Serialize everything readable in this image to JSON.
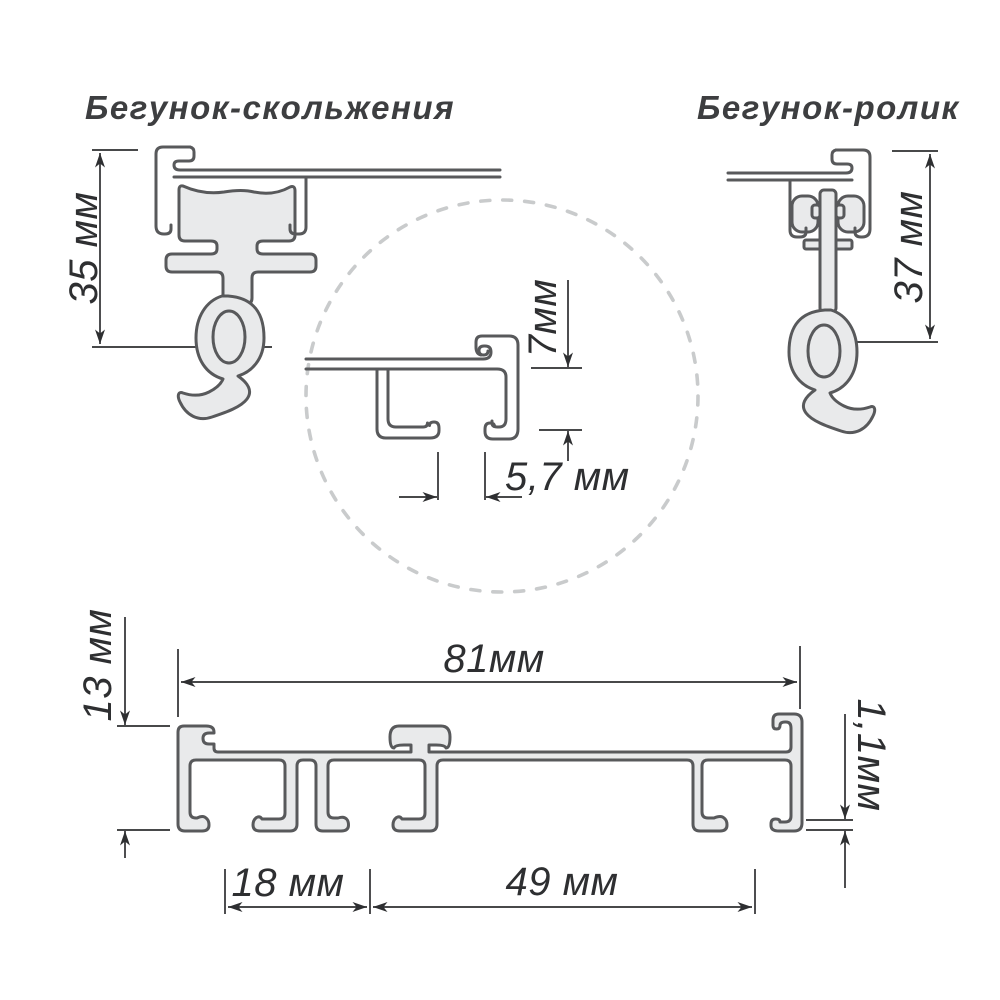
{
  "page": {
    "background": "#ffffff"
  },
  "colors": {
    "outline": "#58595b",
    "profile_fill": "#e9eaeb",
    "dimension": "#2e2f31",
    "dashed_circle": "#c9cbcc",
    "title": "#3d3e40"
  },
  "titles": {
    "left": "Бегунок-скольжения",
    "right": "Бегунок-ролик"
  },
  "dimensions": {
    "slider_height": "35 мм",
    "roller_height": "37 мм",
    "detail_height": "7мм",
    "detail_slot_width": "5,7 мм",
    "profile_height": "13 мм",
    "profile_width": "81мм",
    "wall_thickness": "1,1мм",
    "first_channel_width": "18 мм",
    "second_channel_width": "49 мм"
  }
}
